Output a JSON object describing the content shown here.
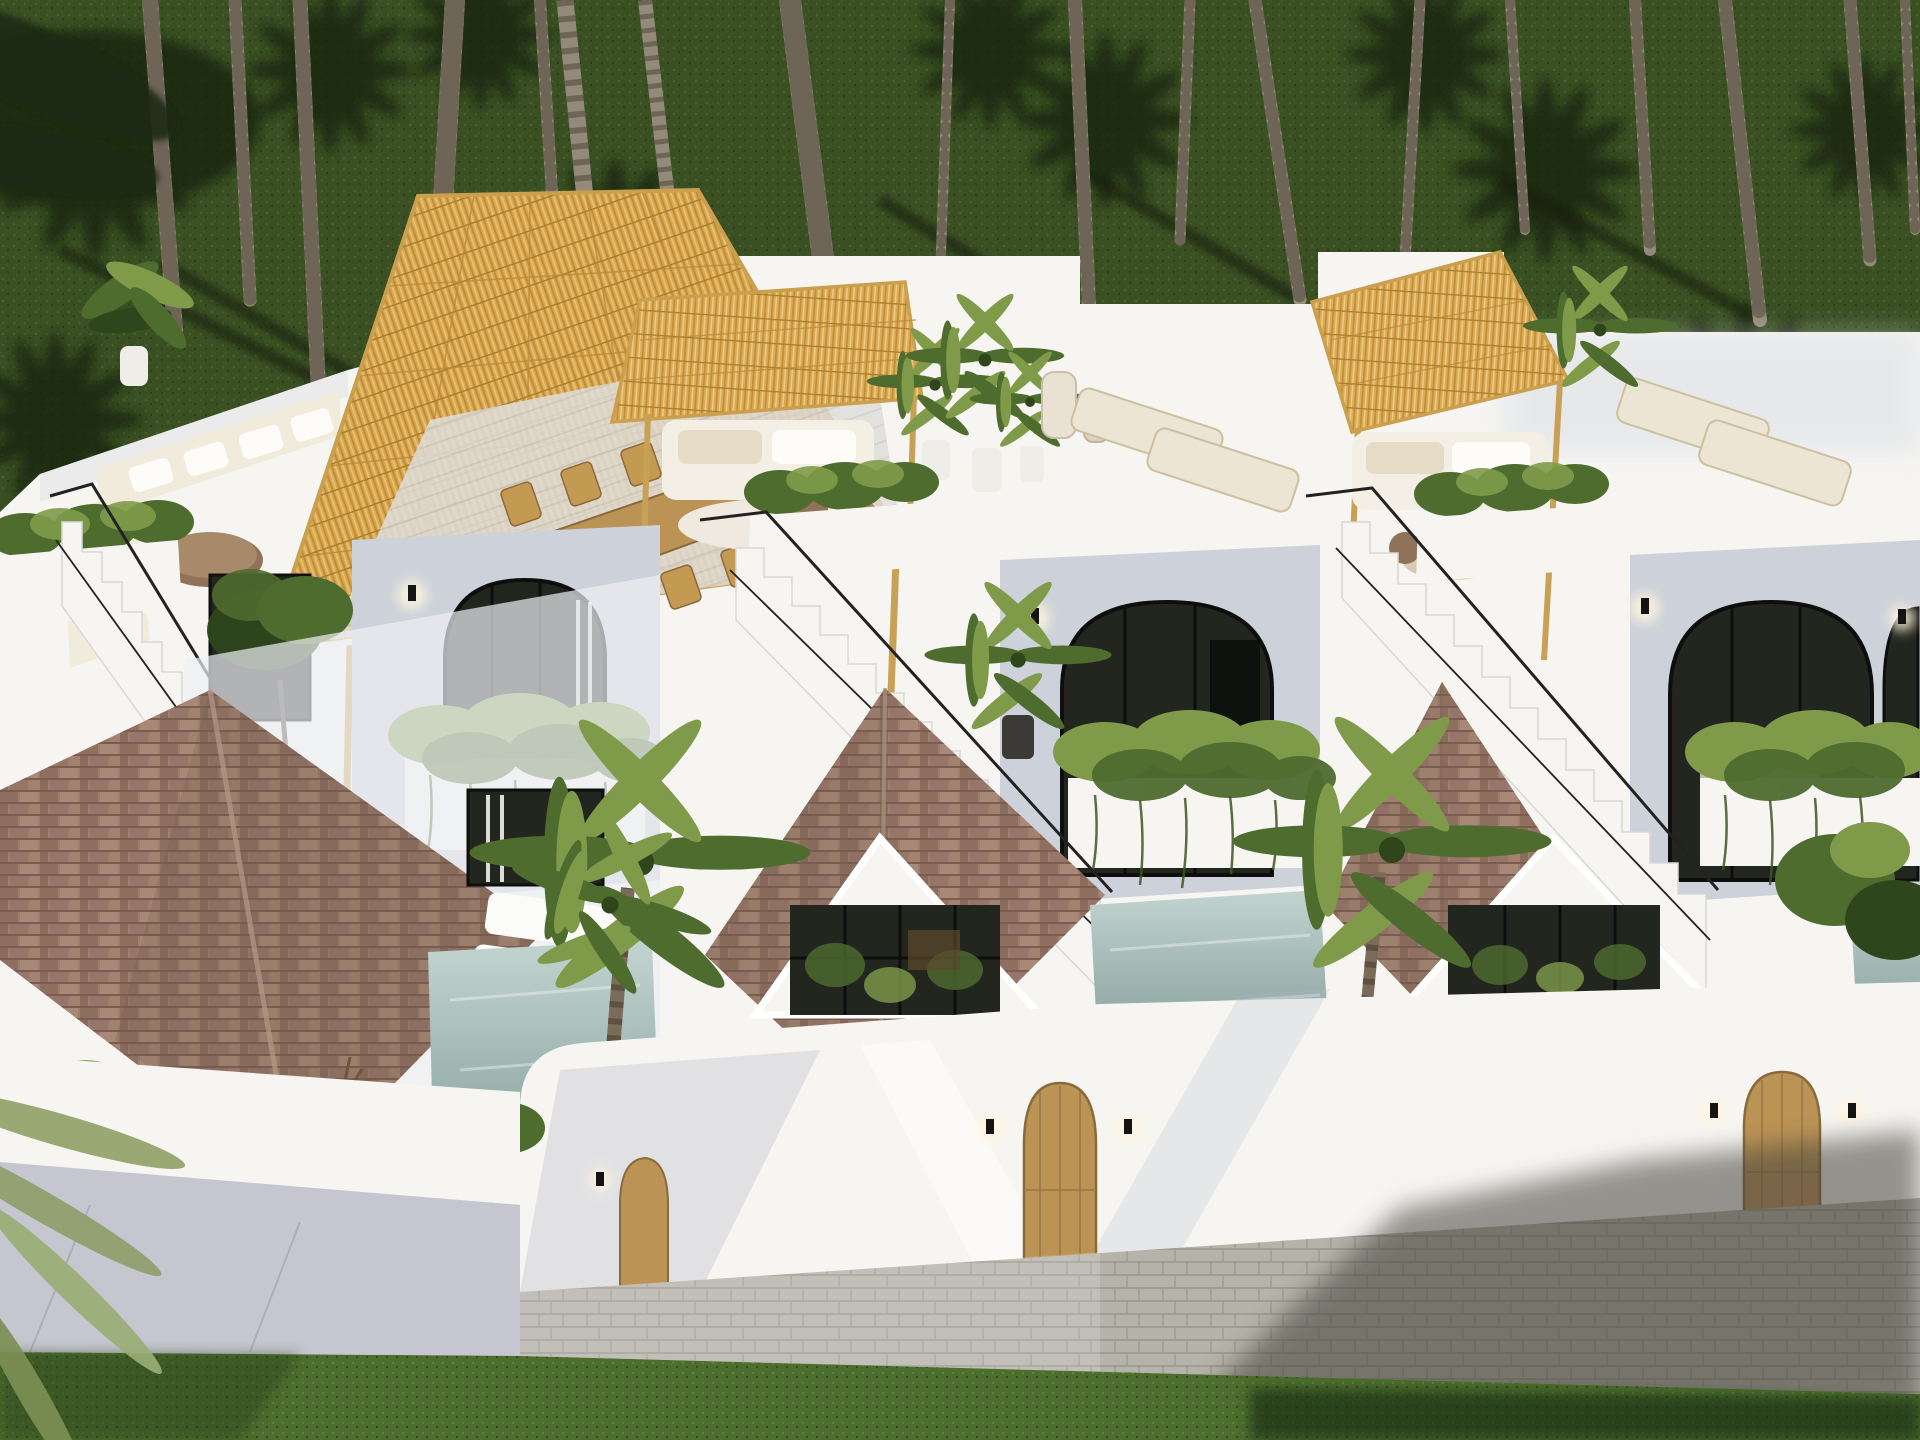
{
  "scene": {
    "title": "aerial-render-of-three-white-tropical-villas",
    "description": "Photorealistic aerial 3D rendering: a row of three attached white minimalist villas with rooftop terraces, bamboo-thatch pergolas, outdoor lounge furniture, vine-draped balconies, arched glass doors, brown shingle hip roofs, plunge pools, palm trees on a dark lawn behind, and a grey paver walkway with lawn strip in front",
    "villa_count": 3,
    "rooftop_items": [
      "thatch-pergola",
      "outdoor-sofa",
      "live-edge-coffee-table",
      "dining-table-with-chairs",
      "sun-loungers",
      "potted-plants",
      "ceramic-vases",
      "planter-hedge"
    ],
    "mid_level_items": [
      "white-staircase",
      "black-railing",
      "arched-glass-door",
      "wall-sconce",
      "vine-balcony"
    ],
    "ground_items": [
      "shingle-hip-roof",
      "white-gable-window",
      "plunge-pool",
      "pool-loungers",
      "palm-tree",
      "privacy-wall",
      "arched-wooden-door",
      "paver-walkway",
      "concrete-pad",
      "lawn-strip"
    ]
  },
  "palette": {
    "grass_dark": "#3a5023",
    "grass_lit": "#4c6e2e",
    "shadow": "#15200e",
    "trunk": "#948a7a",
    "trunk_band": "#655d4f",
    "wall_white": "#f6f5f2",
    "wall_warm": "#efede8",
    "wall_shade": "#ccd1da",
    "wall_deep": "#b7bbc8",
    "thatch": "#d8a751",
    "thatch_dark": "#b08232",
    "roof_light": "#a98b78",
    "roof_dark": "#8d7061",
    "water": "#9fb5b2",
    "wood": "#bb9355",
    "wood_dark": "#8a6a3c",
    "cream": "#ece5d3",
    "leaf": "#4f6c2f",
    "leaf_light": "#7f9b4a",
    "leaf_dark": "#2f461d",
    "pavement": "#b6b3aa",
    "concrete": "#c6c6d0",
    "railing": "#222222",
    "glass": "#23261f"
  }
}
